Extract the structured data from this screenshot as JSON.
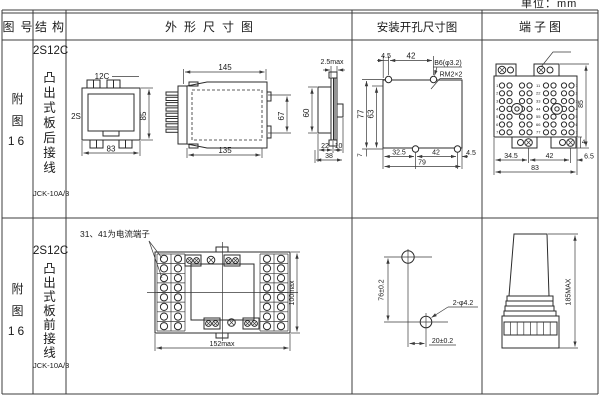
{
  "unit_label": "单位：mm",
  "headers": {
    "fig_no": "图号",
    "structure": "结构",
    "outline": "外形尺寸图",
    "mounting": "安装开孔尺寸图",
    "terminal": "端子图"
  },
  "row1": {
    "fig": {
      "l1": "附",
      "l2": "图",
      "l3": "16"
    },
    "model": "2S12C",
    "structure": "凸出式板后接线",
    "code": "JCK-10A/3",
    "front": {
      "top": "12C",
      "series": "2S",
      "h": "85",
      "w": "83"
    },
    "side": {
      "w_top": "145",
      "w_bot": "135",
      "h_in": "67"
    },
    "profile": {
      "gap": "2.5max",
      "h": "60",
      "d1": "22",
      "d2": "10",
      "d3": "38"
    },
    "mount": {
      "t1": "4.5",
      "t2": "42",
      "hole": "B6(φ3.2)",
      "screw": "RM2×2",
      "v1": "77",
      "v2": "63",
      "b0": "7",
      "b1": "32.5",
      "b2": "42",
      "b3": "4.5",
      "b4": "79"
    },
    "term": {
      "b1": "34.5",
      "b2": "42",
      "b3": "6.5",
      "b4": "83",
      "v1": "85",
      "v2": "4",
      "left": [
        "1",
        "2",
        "3",
        "4",
        "5",
        "6",
        "7"
      ],
      "mid": [
        "11",
        "22",
        "33",
        "44",
        "55",
        "66",
        "77"
      ],
      "right": [
        "1",
        "2",
        "3",
        "4",
        "5",
        "6",
        "7"
      ]
    }
  },
  "row2": {
    "fig": {
      "l1": "附",
      "l2": "图",
      "l3": "16"
    },
    "model": "2S12C",
    "structure": "凸出式板前接线",
    "code": "JCK-10A/3",
    "note": "31、41为电流端子",
    "front": {
      "w": "152max",
      "h": "100max"
    },
    "mount": {
      "v": "76±0.2",
      "hole": "2-φ4.2",
      "h": "20±0.2"
    },
    "side": {
      "h": "185MAX"
    }
  }
}
